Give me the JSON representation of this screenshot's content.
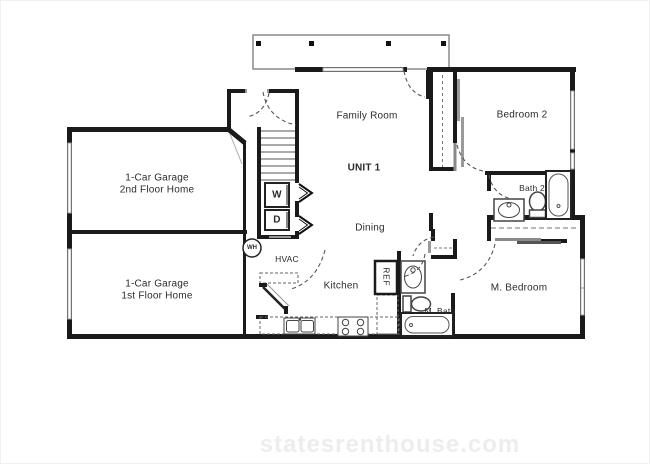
{
  "watermark": "statesrenthouse.com",
  "labels": {
    "family_room": "Family Room",
    "unit": "UNIT 1",
    "dining": "Dining",
    "kitchen": "Kitchen",
    "hvac": "HVAC",
    "bedroom2": "Bedroom 2",
    "bath2": "Bath 2",
    "m_bedroom": "M. Bedroom",
    "m_bath": "M. Bath",
    "ref": "REF",
    "washer": "W",
    "dryer": "D",
    "water_heater": "WH",
    "garage_upper_line1": "1-Car Garage",
    "garage_upper_line2": "2nd Floor Home",
    "garage_lower_line1": "1-Car Garage",
    "garage_lower_line2": "1st Floor Home"
  },
  "colors": {
    "wall": "#1a1a1a",
    "window": "#999999",
    "dashed_line": "#555555",
    "label_text": "#2b2b2b",
    "watermark": "#ededed",
    "background": "#ffffff"
  }
}
